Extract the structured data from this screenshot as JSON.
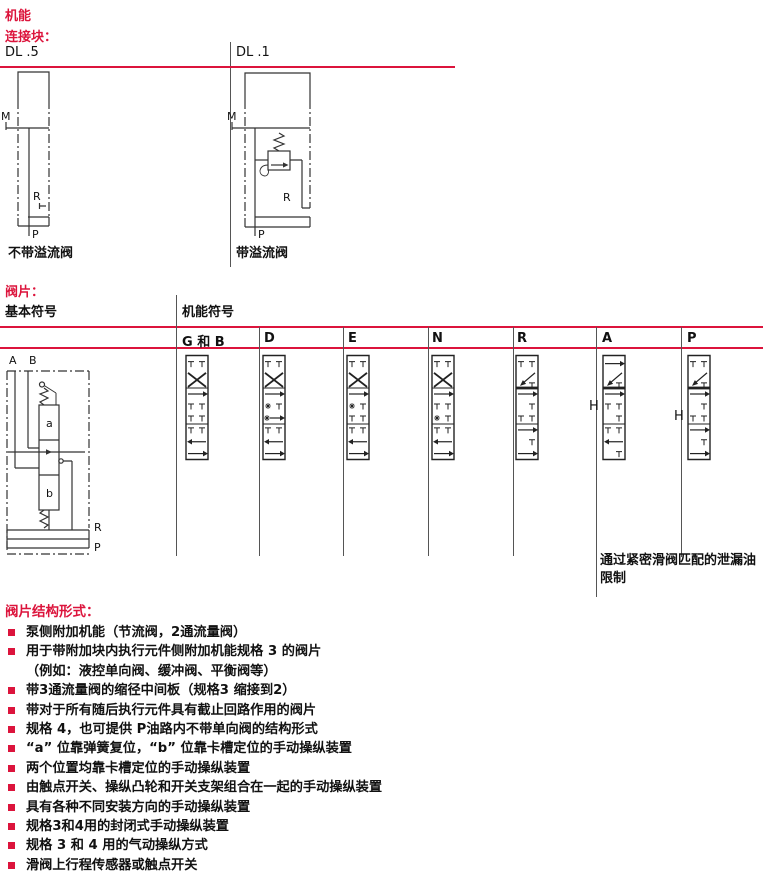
{
  "page": {
    "title": "机能",
    "accent_color": "#dc143c"
  },
  "connection_block": {
    "label": "连接块：",
    "columns": [
      {
        "code": "DL .5",
        "caption": "不带溢流阀",
        "ports": {
          "m": "M",
          "r": "R",
          "p": "P"
        }
      },
      {
        "code": "DL .1",
        "caption": "带溢流阀",
        "ports": {
          "m": "M",
          "r": "R",
          "p": "P"
        }
      }
    ]
  },
  "valve_section": {
    "label": "阀片：",
    "basic_symbol_header": "基本符号",
    "function_symbol_header": "机能符号",
    "basic_symbol": {
      "ports": {
        "a": "A",
        "b": "B",
        "r": "R",
        "p": "P"
      },
      "positions": {
        "pos_a": "a",
        "pos_b": "b"
      }
    },
    "columns": [
      {
        "label": "G 和 B"
      },
      {
        "label": "D"
      },
      {
        "label": "E"
      },
      {
        "label": "N"
      },
      {
        "label": "R"
      },
      {
        "label": "A",
        "annotation": "H"
      },
      {
        "label": "P",
        "annotation": "H"
      }
    ],
    "note": "通过紧密滑阀匹配的泄漏油限制"
  },
  "structure_list": {
    "heading": "阀片结构形式：",
    "items": [
      {
        "bullet": true,
        "text": "泵侧附加机能（节流阀，2通流量阀）"
      },
      {
        "bullet": true,
        "text": "用于带附加块内执行元件侧附加机能规格 3 的阀片"
      },
      {
        "bullet": false,
        "text": "（例如：液控单向阀、缓冲阀、平衡阀等）"
      },
      {
        "bullet": true,
        "text": "带3通流量阀的缩径中间板（规格3 缩接到2）"
      },
      {
        "bullet": true,
        "text": "带对于所有随后执行元件具有截止回路作用的阀片"
      },
      {
        "bullet": true,
        "text": "规格 4，也可提供 P油路内不带单向阀的结构形式"
      },
      {
        "bullet": true,
        "text": "“a” 位靠弹簧复位，“b” 位靠卡槽定位的手动操纵装置"
      },
      {
        "bullet": true,
        "text": "两个位置均靠卡槽定位的手动操纵装置"
      },
      {
        "bullet": true,
        "text": "由触点开关、操纵凸轮和开关支架组合在一起的手动操纵装置"
      },
      {
        "bullet": true,
        "text": "具有各种不同安装方向的手动操纵装置"
      },
      {
        "bullet": true,
        "text": "规格3和4用的封闭式手动操纵装置"
      },
      {
        "bullet": true,
        "text": "规格 3 和 4 用的气动操纵方式"
      },
      {
        "bullet": true,
        "text": "滑阀上行程传感器或触点开关"
      }
    ]
  }
}
